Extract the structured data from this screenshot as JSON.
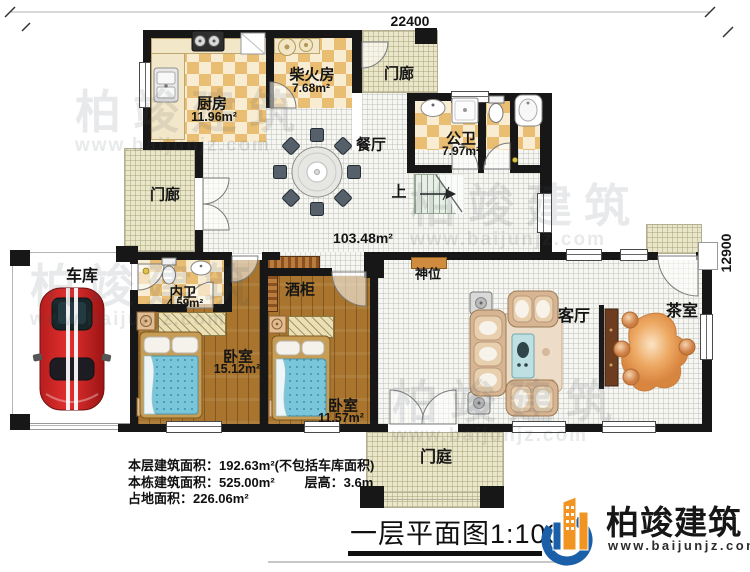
{
  "plan": {
    "dim_top": "22400",
    "dim_right": "12900",
    "rooms": {
      "kitchen": {
        "name": "厨房",
        "area": "11.96m²"
      },
      "firewood": {
        "name": "柴火房",
        "area": "7.68m²"
      },
      "porch_top": {
        "name": "门廊"
      },
      "porch_left": {
        "name": "门廊"
      },
      "dining": {
        "name": "餐厅"
      },
      "public_bath": {
        "name": "公卫",
        "area": "7.97m²"
      },
      "stairs": {
        "name": "上"
      },
      "hall": {
        "area": "103.48m²"
      },
      "shrine": {
        "name": "神位"
      },
      "garage": {
        "name": "车库"
      },
      "inner_bath": {
        "name": "内卫",
        "area": "4.59m²"
      },
      "wine_cabinet": {
        "name": "酒柜"
      },
      "bedroom_big": {
        "name": "卧室",
        "area": "15.12m²"
      },
      "bedroom_small": {
        "name": "卧室",
        "area": "11.57m²"
      },
      "living": {
        "name": "客厅"
      },
      "tea": {
        "name": "茶室"
      },
      "entry": {
        "name": "门庭"
      }
    }
  },
  "notes": {
    "line1": "本层建筑面积：192.63m²(不包括车库面积)",
    "line2a": "本栋建筑面积：525.00m²",
    "line2b": "层高：3.6m",
    "line3": "占地面积：226.06m²"
  },
  "title": "一层平面图1:100",
  "brand": {
    "name": "柏竣建筑",
    "url": "www.baijunjz.com"
  },
  "watermark": {
    "name": "柏竣建筑",
    "url": "www.baijunjz.com"
  },
  "colors": {
    "brand_blue": "#1a5fa8",
    "brand_orange": "#f29421",
    "wall": "#171717"
  }
}
